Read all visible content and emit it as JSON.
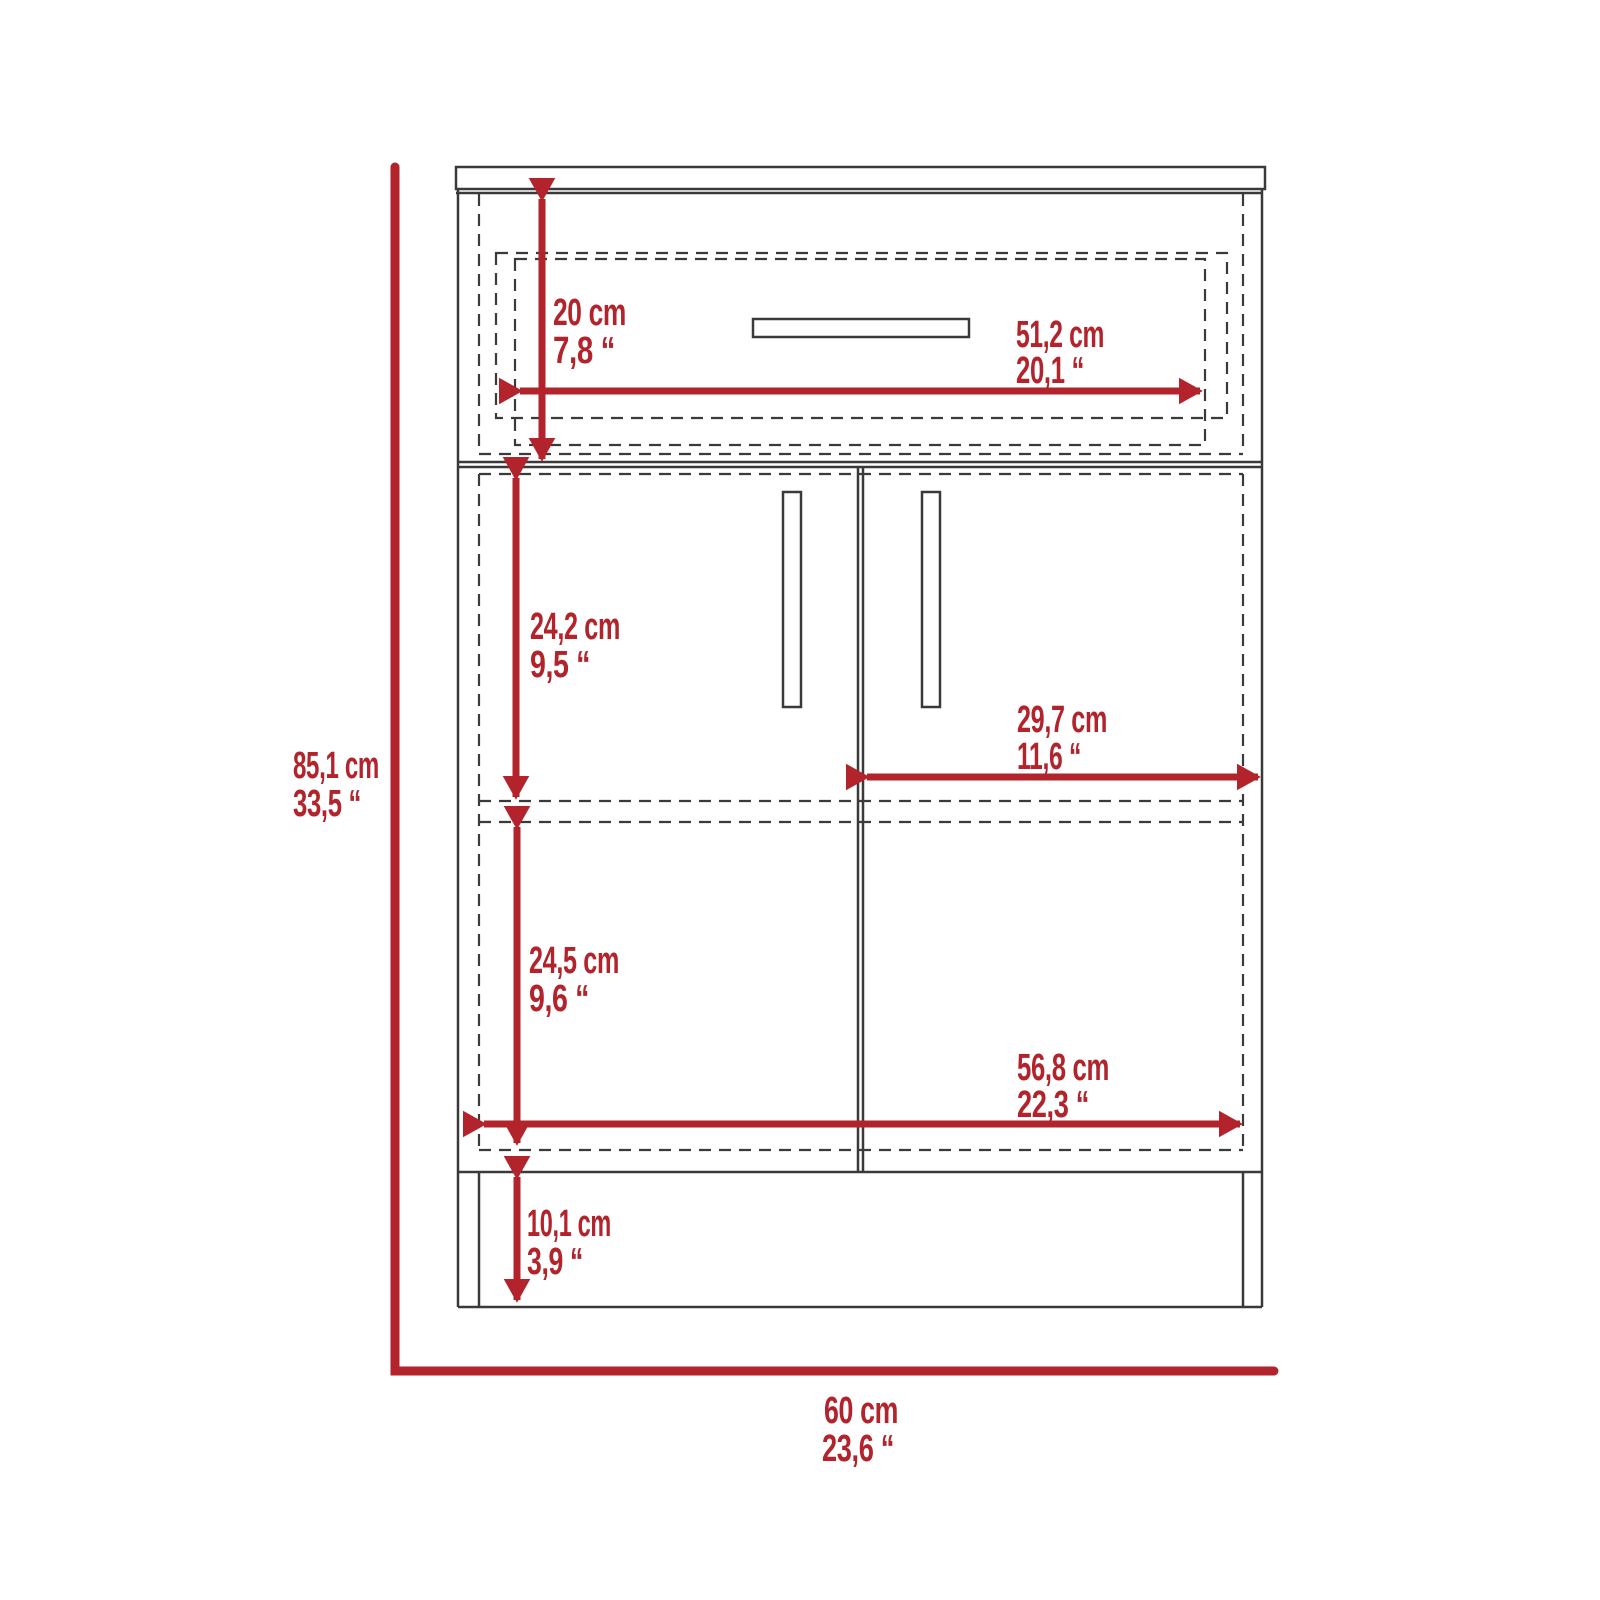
{
  "diagram": {
    "description_labels": [],
    "units": {
      "metric_suffix": "cm",
      "imperial_suffix": "“"
    }
  },
  "dimensions": {
    "overall_height": {
      "cm": "85,1 cm",
      "inches": "33,5 “"
    },
    "overall_width": {
      "cm": "60 cm",
      "inches": "23,6 “"
    },
    "drawer_height": {
      "cm": "20 cm",
      "inches": "7,8 “"
    },
    "drawer_width": {
      "cm": "51,2 cm",
      "inches": "20,1 “"
    },
    "upper_compartment_height": {
      "cm": "24,2 cm",
      "inches": "9,5 “"
    },
    "right_door_width": {
      "cm": "29,7 cm",
      "inches": "11,6 “"
    },
    "lower_compartment_height": {
      "cm": "24,5 cm",
      "inches": "9,6 “"
    },
    "interior_width": {
      "cm": "56,8 cm",
      "inches": "22,3 “"
    },
    "base_height": {
      "cm": "10,1 cm",
      "inches": "3,9 “"
    }
  },
  "colors": {
    "dimension_red": "#b2232b",
    "outline_dark": "#3a3a3a",
    "background": "#ffffff"
  }
}
